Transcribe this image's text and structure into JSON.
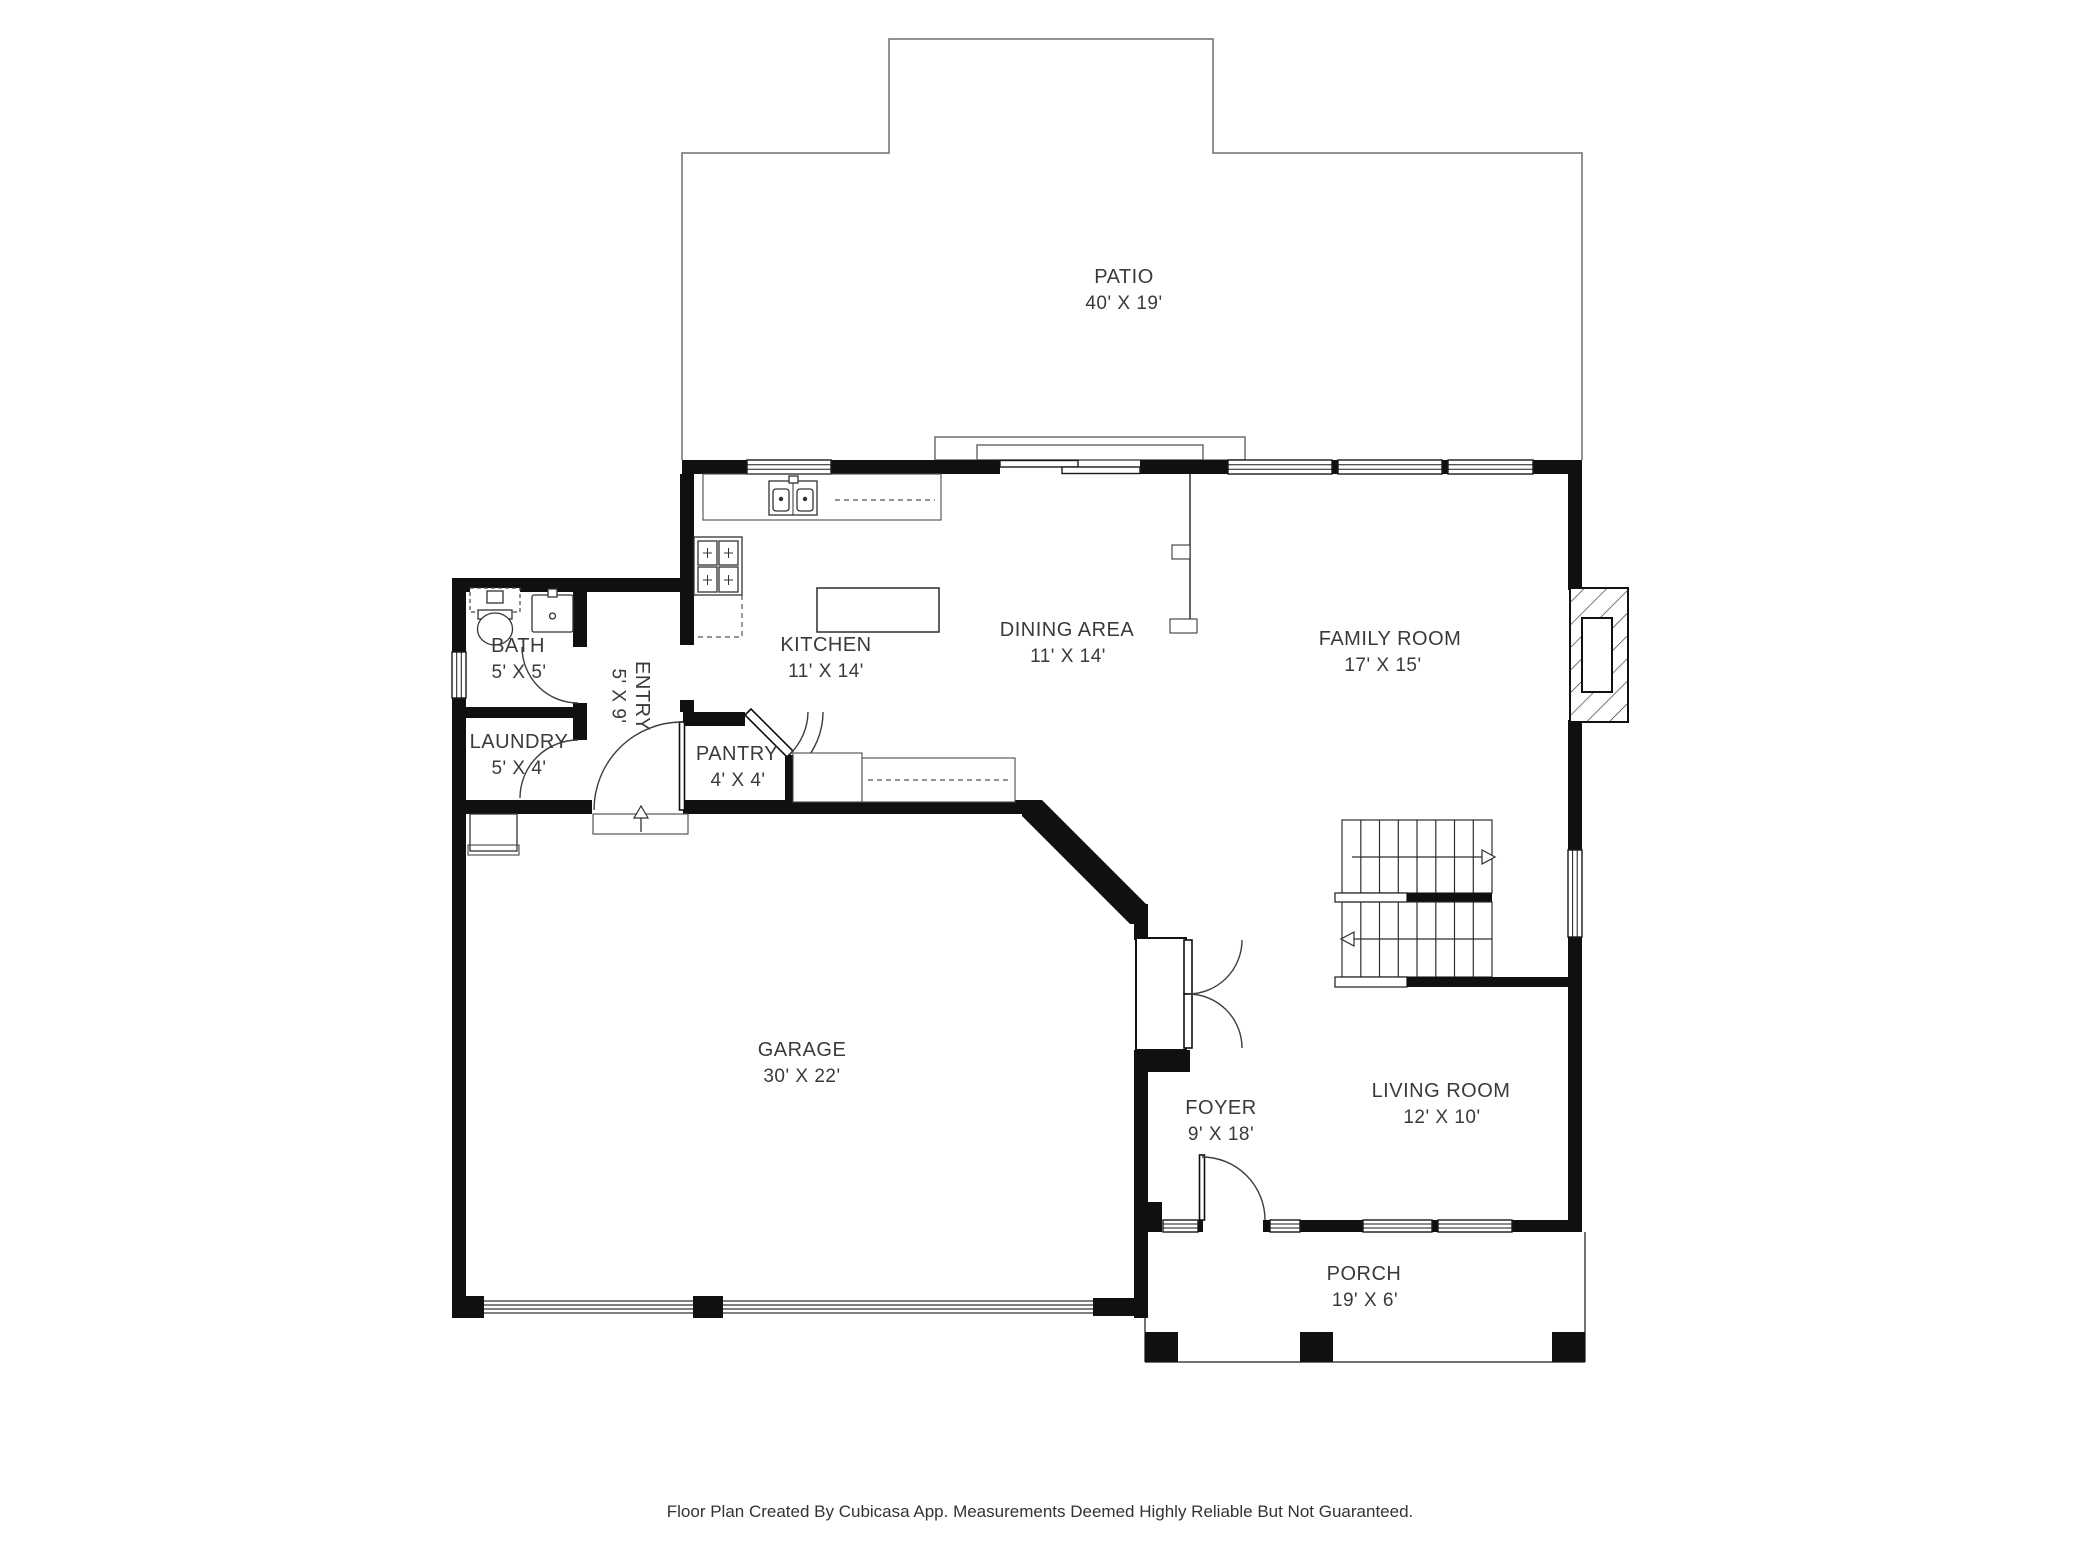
{
  "plan": {
    "wall_color": "#101010",
    "line_color": "#6e6e6e",
    "text_color": "#3a3a3a",
    "rooms": [
      {
        "name": "PATIO",
        "dims": "40' X 19'"
      },
      {
        "name": "KITCHEN",
        "dims": "11' X 14'"
      },
      {
        "name": "DINING AREA",
        "dims": "11' X 14'"
      },
      {
        "name": "FAMILY ROOM",
        "dims": "17' X 15'"
      },
      {
        "name": "BATH",
        "dims": "5' X 5'"
      },
      {
        "name": "ENTRY",
        "dims": "5' X 9'"
      },
      {
        "name": "LAUNDRY",
        "dims": "5' X 4'"
      },
      {
        "name": "PANTRY",
        "dims": "4' X 4'"
      },
      {
        "name": "GARAGE",
        "dims": "30' X 22'"
      },
      {
        "name": "FOYER",
        "dims": "9' X 18'"
      },
      {
        "name": "LIVING ROOM",
        "dims": "12' X 10'"
      },
      {
        "name": "PORCH",
        "dims": "19' X 6'"
      }
    ],
    "fixtures": [
      "toilet",
      "bathroom-sink",
      "kitchen-sink",
      "cooktop",
      "kitchen-island",
      "pantry-corner-door",
      "fireplace",
      "staircase",
      "foyer-closet",
      "front-door",
      "entry-door",
      "garage-doors",
      "porch-pillars"
    ]
  },
  "footer": {
    "text": "Floor Plan Created By Cubicasa App. Measurements Deemed Highly Reliable But Not Guaranteed."
  }
}
